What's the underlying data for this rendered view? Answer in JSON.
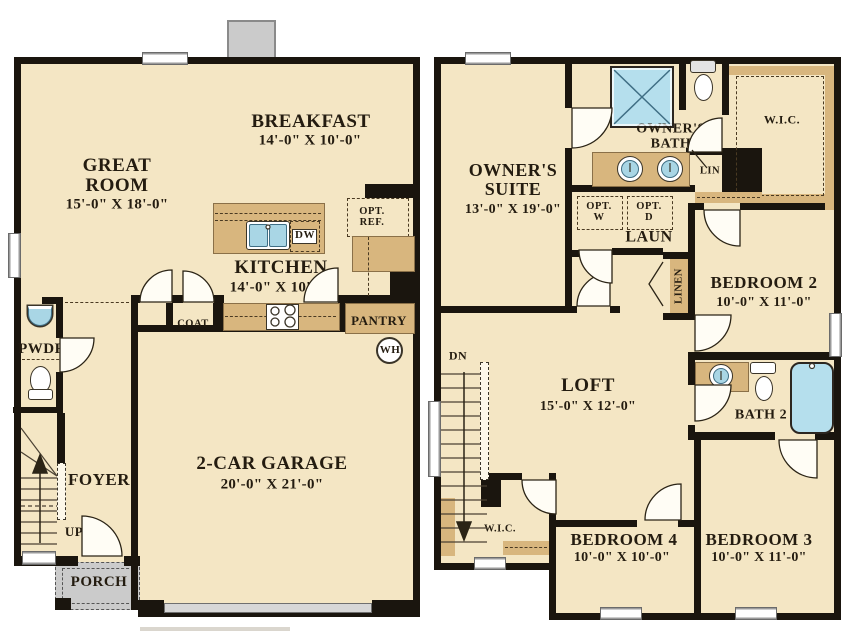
{
  "colors": {
    "floor": "#f4e6c4",
    "wall": "#1a150e",
    "cabinet_tan": "#d8b67e",
    "fixture_blue": "#a9d6e5",
    "porch_gray": "#cbcbcb",
    "text": "#241c10"
  },
  "first_floor": {
    "great_room": {
      "name": "GREAT ROOM",
      "dims": "15'-0\" X 18'-0\""
    },
    "breakfast": {
      "name": "BREAKFAST",
      "dims": "14'-0\" X 10'-0\""
    },
    "kitchen": {
      "name": "KITCHEN",
      "dims": "14'-0\" X 10'-0\""
    },
    "garage": {
      "name": "2-CAR GARAGE",
      "dims": "20'-0\" X 21'-0\""
    },
    "foyer": {
      "name": "FOYER"
    },
    "pwdr": {
      "name": "PWDR"
    },
    "porch": {
      "name": "PORCH"
    },
    "coat": {
      "name": "COAT"
    },
    "pantry": {
      "name": "PANTRY"
    },
    "opt_ref": {
      "name": "OPT. REF."
    },
    "dw": {
      "name": "DW"
    },
    "wh": {
      "name": "WH"
    },
    "up": {
      "name": "UP"
    }
  },
  "second_floor": {
    "owners_suite": {
      "name": "OWNER'S SUITE",
      "dims": "13'-0\" X 19'-0\""
    },
    "owners_bath": {
      "name": "OWNER'S BATH"
    },
    "wic_owner": {
      "name": "W.I.C."
    },
    "lin": {
      "name": "LIN"
    },
    "opt_w": {
      "name": "OPT. W"
    },
    "opt_d": {
      "name": "OPT. D"
    },
    "laun": {
      "name": "LAUN"
    },
    "linen": {
      "name": "LINEN"
    },
    "bedroom2": {
      "name": "BEDROOM 2",
      "dims": "10'-0\" X 11'-0\""
    },
    "loft": {
      "name": "LOFT",
      "dims": "15'-0\" X 12'-0\""
    },
    "bath2": {
      "name": "BATH 2"
    },
    "dn": {
      "name": "DN"
    },
    "wic2": {
      "name": "W.I.C."
    },
    "bedroom4": {
      "name": "BEDROOM 4",
      "dims": "10'-0\" X 10'-0\""
    },
    "bedroom3": {
      "name": "BEDROOM 3",
      "dims": "10'-0\" X 11'-0\""
    }
  }
}
